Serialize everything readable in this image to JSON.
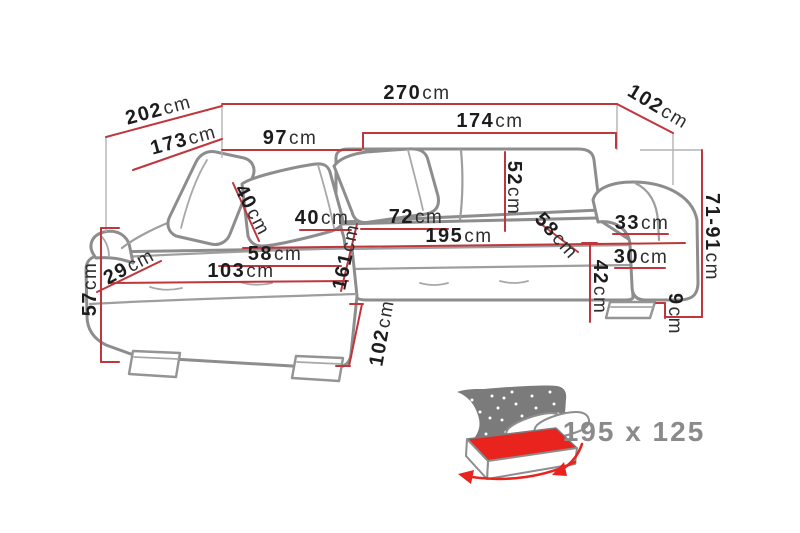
{
  "diagram_type": "corner-sofa-dimension-diagram",
  "colors": {
    "dimension_red": "#bf363d",
    "sofa_gray": "#8d8d8d",
    "label_black": "#1c1c1c",
    "icon_red": "#e9241f",
    "icon_gray": "#7b7b7b",
    "size_text_gray": "#8a8a8a"
  },
  "dims": {
    "w270": {
      "value": "270",
      "unit": "cm"
    },
    "w102_top": {
      "value": "102",
      "unit": "cm"
    },
    "w202": {
      "value": "202",
      "unit": "cm"
    },
    "w173": {
      "value": "173",
      "unit": "cm"
    },
    "w97": {
      "value": "97",
      "unit": "cm"
    },
    "w174": {
      "value": "174",
      "unit": "cm"
    },
    "h52": {
      "value": "52",
      "unit": "cm"
    },
    "w40_pillow": {
      "value": "40",
      "unit": "cm"
    },
    "w40_seat": {
      "value": "40",
      "unit": "cm"
    },
    "w72": {
      "value": "72",
      "unit": "cm"
    },
    "w195": {
      "value": "195",
      "unit": "cm"
    },
    "d58_seat": {
      "value": "58",
      "unit": "cm"
    },
    "d58_back": {
      "value": "58",
      "unit": "cm"
    },
    "w33": {
      "value": "33",
      "unit": "cm"
    },
    "w30": {
      "value": "30",
      "unit": "cm"
    },
    "h42": {
      "value": "42",
      "unit": "cm"
    },
    "w103": {
      "value": "103",
      "unit": "cm"
    },
    "d29": {
      "value": "29",
      "unit": "cm"
    },
    "d161": {
      "value": "161",
      "unit": "cm"
    },
    "h57": {
      "value": "57",
      "unit": "cm"
    },
    "d102_bottom": {
      "value": "102",
      "unit": "cm"
    },
    "h71_91": {
      "value": "71-91",
      "unit": "cm"
    },
    "h9": {
      "value": "9",
      "unit": "cm"
    }
  },
  "sleeping_area": {
    "icon": "sofa-bed-sleeping-function-icon",
    "size": "195 x 125"
  }
}
